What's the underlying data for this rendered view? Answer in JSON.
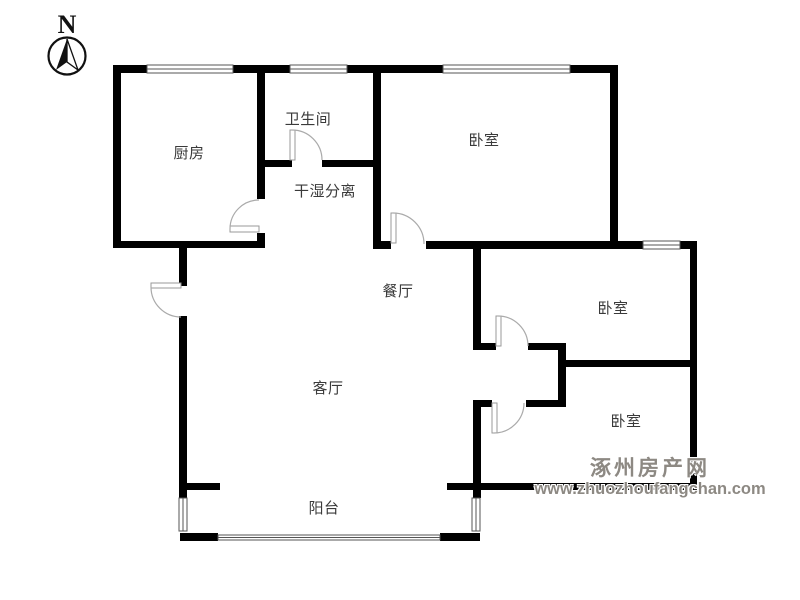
{
  "compass": {
    "label": "N"
  },
  "rooms": [
    {
      "id": "kitchen",
      "name": "厨房"
    },
    {
      "id": "bathroom",
      "name": "卫生间"
    },
    {
      "id": "dry-wet-separation",
      "name": "干湿分离"
    },
    {
      "id": "bedroom-north",
      "name": "卧室"
    },
    {
      "id": "dining-room",
      "name": "餐厅"
    },
    {
      "id": "bedroom-east",
      "name": "卧室"
    },
    {
      "id": "bedroom-southeast",
      "name": "卧室"
    },
    {
      "id": "living-room",
      "name": "客厅"
    },
    {
      "id": "balcony",
      "name": "阳台"
    }
  ],
  "watermark": {
    "site_name": "涿州房产网",
    "site_url": "www.zhuozhoufangchan.com",
    "color": "#8d8983"
  },
  "colors": {
    "background": "#ffffff",
    "wall": "#000000",
    "label_text": "#3a3a3a",
    "door_arc": "#aaaaaa",
    "window_line": "#555555"
  }
}
